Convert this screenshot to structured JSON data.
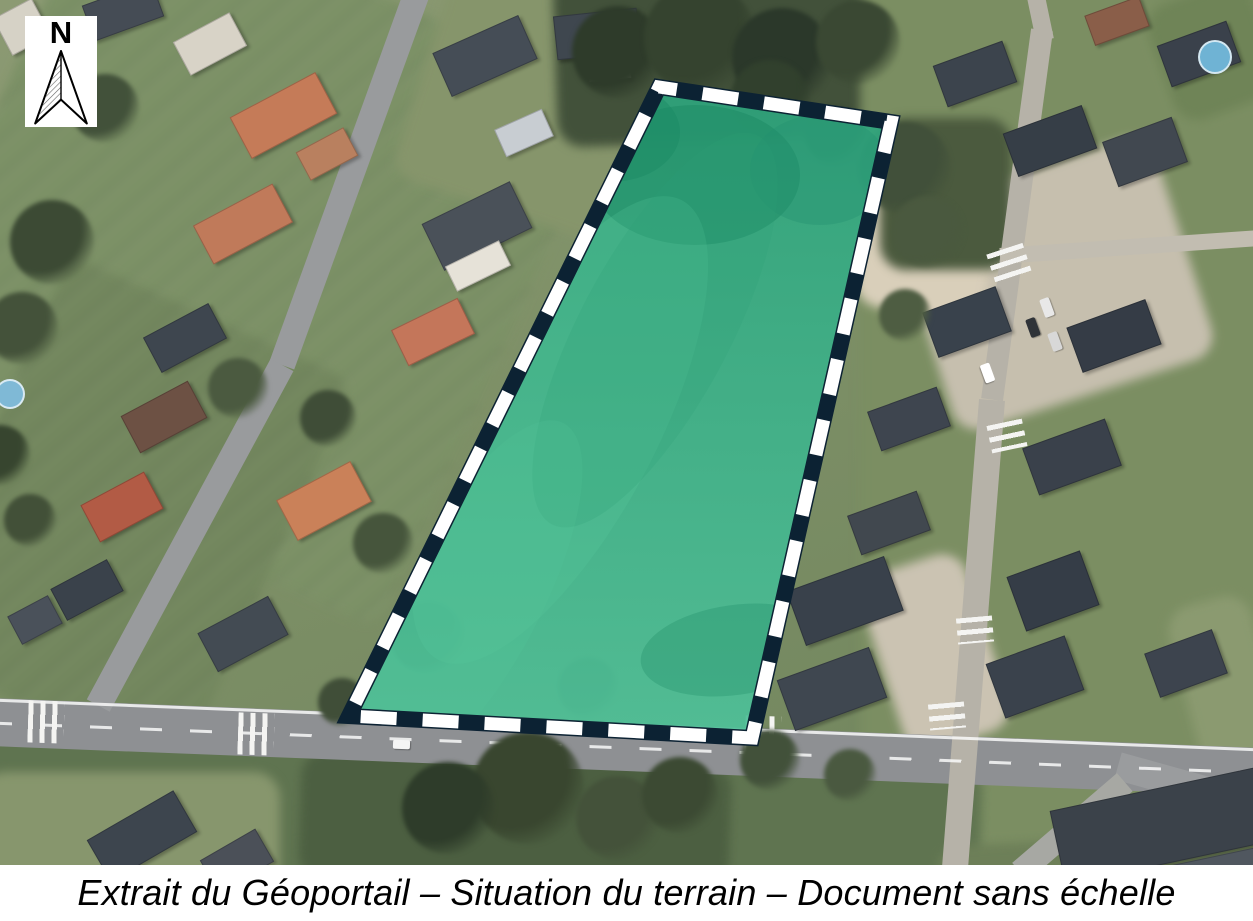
{
  "meta": {
    "width": 1253,
    "height": 921,
    "photo_height": 865
  },
  "caption": {
    "text": "Extrait du Géoportail – Situation du terrain – Document sans échelle"
  },
  "compass": {
    "label": "N"
  },
  "parcel": {
    "points": [
      [
        659,
        87
      ],
      [
        891,
        122
      ],
      [
        752,
        738
      ],
      [
        349,
        716
      ]
    ],
    "fill_top": "#2ea37b",
    "fill_bottom": "#4fc098",
    "fill_opacity": 0.93,
    "outline_color": "#0c2233",
    "outline_width": 16,
    "dash_color": "#ffffff",
    "dash_width": 13,
    "dash_length": 36,
    "dash_gap": 26,
    "shading": [
      [
        695,
        175,
        105,
        70,
        0,
        "#1b8a63",
        0.5
      ],
      [
        610,
        132,
        70,
        50,
        0,
        "#1b8a63",
        0.45
      ],
      [
        820,
        170,
        70,
        55,
        0,
        "#239070",
        0.35
      ],
      [
        735,
        650,
        95,
        45,
        -8,
        "#1f8d66",
        0.32
      ],
      [
        560,
        430,
        260,
        95,
        -62,
        "#5acb9f",
        0.22
      ],
      [
        655,
        330,
        220,
        75,
        -62,
        "#2f9e77",
        0.22
      ],
      [
        470,
        600,
        200,
        70,
        -62,
        "#55c69c",
        0.2
      ]
    ]
  },
  "scene": {
    "patches": [
      {
        "x": -40,
        "y": -40,
        "w": 560,
        "h": 580,
        "rot": 24,
        "c": "#7c9166",
        "stripes": true
      },
      {
        "x": -30,
        "y": 300,
        "w": 310,
        "h": 430,
        "rot": 24,
        "c": "#73875e",
        "stripes": true
      },
      {
        "x": 420,
        "y": -20,
        "w": 260,
        "h": 240,
        "rot": 18,
        "c": "#86956b",
        "stripes": false
      },
      {
        "x": 555,
        "y": -35,
        "w": 440,
        "h": 175,
        "rot": -2,
        "c": "#42513a",
        "stripes": false
      },
      {
        "x": 860,
        "y": -20,
        "w": 420,
        "h": 920,
        "rot": 0,
        "c": "#7b8e62",
        "stripes": false
      },
      {
        "x": 918,
        "y": 168,
        "w": 272,
        "h": 232,
        "rot": -18,
        "c": "#c6bfae",
        "stripes": false
      },
      {
        "x": 862,
        "y": 185,
        "w": 130,
        "h": 130,
        "rot": 10,
        "c": "#d9cfba",
        "stripes": false
      },
      {
        "x": 880,
        "y": 560,
        "w": 110,
        "h": 185,
        "rot": -18,
        "c": "#cbc3b2",
        "stripes": false
      },
      {
        "x": -20,
        "y": 748,
        "w": 1000,
        "h": 190,
        "rot": 2,
        "c": "#5f7450",
        "stripes": false
      },
      {
        "x": -20,
        "y": 772,
        "w": 300,
        "h": 160,
        "rot": 0,
        "c": "#87966d",
        "stripes": false
      },
      {
        "x": 300,
        "y": 757,
        "w": 430,
        "h": 130,
        "rot": 2,
        "c": "#4c5f41",
        "stripes": false
      },
      {
        "x": 880,
        "y": 118,
        "w": 132,
        "h": 152,
        "rot": 0,
        "c": "#4b5a3e",
        "stripes": false
      },
      {
        "x": 1158,
        "y": -10,
        "w": 110,
        "h": 122,
        "rot": -20,
        "c": "#6f8457",
        "stripes": false
      },
      {
        "x": 938,
        "y": 838,
        "w": 345,
        "h": 95,
        "rot": -3,
        "c": "#6d7f58",
        "stripes": false
      },
      {
        "x": 1188,
        "y": 598,
        "w": 85,
        "h": 205,
        "rot": -15,
        "c": "#8b9a70",
        "stripes": false
      }
    ],
    "roads": [
      [
        -10,
        722,
        1263,
        772,
        48,
        "#8e9093"
      ],
      [
        418,
        -10,
        282,
        365,
        26,
        "#999b9d"
      ],
      [
        282,
        365,
        98,
        706,
        26,
        "#999b9d"
      ],
      [
        1042,
        30,
        992,
        400,
        22,
        "#b6b2a8"
      ],
      [
        992,
        400,
        955,
        868,
        26,
        "#b6b2a8"
      ],
      [
        1000,
        256,
        1260,
        238,
        16,
        "#c2bdb1"
      ],
      [
        1118,
        766,
        1262,
        806,
        28,
        "#9a9c9e"
      ],
      [
        1020,
        872,
        1125,
        782,
        24,
        "#a7a8a3"
      ],
      [
        1035,
        -8,
        1045,
        40,
        18,
        "#b6b2a8"
      ]
    ],
    "road_lines": [
      [
        -10,
        700,
        1263,
        750,
        3,
        "solid"
      ],
      [
        -10,
        723,
        1263,
        773,
        3,
        "dashed"
      ]
    ],
    "crosswalks": [
      [
        28,
        701,
        2,
        36,
        42
      ],
      [
        238,
        713,
        2,
        36,
        42
      ],
      [
        745,
        716,
        2,
        36,
        42
      ],
      [
        994,
        244,
        72,
        30,
        38
      ],
      [
        993,
        418,
        78,
        28,
        36
      ],
      [
        962,
        612,
        85,
        26,
        36
      ],
      [
        934,
        698,
        85,
        26,
        36
      ]
    ],
    "houses": [
      [
        0,
        6,
        42,
        40,
        -28,
        "#d6d2c6"
      ],
      [
        86,
        -8,
        72,
        36,
        -20,
        "#454c55"
      ],
      [
        235,
        92,
        95,
        45,
        -28,
        "#c57b58"
      ],
      [
        300,
        138,
        52,
        30,
        -28,
        "#b9805f"
      ],
      [
        178,
        25,
        62,
        36,
        -28,
        "#d8d3c7"
      ],
      [
        438,
        32,
        92,
        46,
        -24,
        "#454d56"
      ],
      [
        498,
        118,
        50,
        28,
        -24,
        "#c8cdd2"
      ],
      [
        555,
        12,
        82,
        42,
        -6,
        "#3f474f"
      ],
      [
        588,
        54,
        40,
        24,
        -6,
        "#e4dfd4"
      ],
      [
        198,
        202,
        88,
        42,
        -28,
        "#c07a5a"
      ],
      [
        428,
        200,
        96,
        50,
        -26,
        "#4a5159"
      ],
      [
        448,
        252,
        58,
        26,
        -26,
        "#e6e2d8"
      ],
      [
        396,
        312,
        72,
        38,
        -26,
        "#c4765a"
      ],
      [
        148,
        318,
        72,
        38,
        -28,
        "#3e464f"
      ],
      [
        126,
        396,
        74,
        40,
        -28,
        "#6d5144"
      ],
      [
        86,
        486,
        70,
        40,
        -28,
        "#b25b45"
      ],
      [
        282,
        478,
        82,
        44,
        -28,
        "#ca8159"
      ],
      [
        203,
        612,
        78,
        42,
        -28,
        "#434b53"
      ],
      [
        55,
        572,
        62,
        34,
        -28,
        "#3a424b"
      ],
      [
        12,
        604,
        44,
        30,
        -28,
        "#4a515a"
      ],
      [
        92,
        812,
        98,
        46,
        -30,
        "#3d454e"
      ],
      [
        205,
        842,
        62,
        36,
        -30,
        "#4b5058"
      ],
      [
        938,
        52,
        72,
        42,
        -20,
        "#3c444d"
      ],
      [
        1008,
        118,
        82,
        44,
        -20,
        "#363e47"
      ],
      [
        1108,
        128,
        72,
        46,
        -20,
        "#414850"
      ],
      [
        1162,
        32,
        72,
        42,
        -20,
        "#3a414b"
      ],
      [
        1088,
        5,
        56,
        30,
        -20,
        "#8a5e49"
      ],
      [
        928,
        298,
        76,
        46,
        -20,
        "#39424c"
      ],
      [
        1072,
        312,
        82,
        46,
        -20,
        "#353c46"
      ],
      [
        872,
        398,
        72,
        40,
        -20,
        "#3e454f"
      ],
      [
        1028,
        432,
        86,
        48,
        -20,
        "#3a414b"
      ],
      [
        852,
        502,
        72,
        40,
        -20,
        "#41484f"
      ],
      [
        793,
        572,
        102,
        56,
        -20,
        "#39414b"
      ],
      [
        783,
        662,
        96,
        52,
        -20,
        "#3f4750"
      ],
      [
        1014,
        562,
        76,
        56,
        -20,
        "#353d47"
      ],
      [
        993,
        648,
        82,
        56,
        -20,
        "#3a424c"
      ],
      [
        1150,
        640,
        70,
        45,
        -20,
        "#3d444e"
      ],
      [
        1055,
        786,
        230,
        74,
        -12,
        "#3b424a"
      ],
      [
        1145,
        852,
        180,
        48,
        -12,
        "#50575f"
      ]
    ],
    "trees": [
      [
        618,
        52,
        46,
        "#2e3b2a"
      ],
      [
        700,
        38,
        56,
        "#35432f"
      ],
      [
        782,
        58,
        50,
        "#2b382a"
      ],
      [
        858,
        42,
        42,
        "#3a4833"
      ],
      [
        905,
        168,
        46,
        "#41503a"
      ],
      [
        928,
        232,
        36,
        "#4a593f"
      ],
      [
        52,
        242,
        42,
        "#3c4a34"
      ],
      [
        22,
        328,
        36,
        "#44523a"
      ],
      [
        238,
        388,
        30,
        "#4b5a40"
      ],
      [
        328,
        418,
        28,
        "#3f4d37"
      ],
      [
        383,
        543,
        30,
        "#46553c"
      ],
      [
        428,
        638,
        36,
        "#3b4933"
      ],
      [
        528,
        788,
        56,
        "#39462f"
      ],
      [
        448,
        808,
        46,
        "#2e3c2a"
      ],
      [
        618,
        818,
        42,
        "#44523a"
      ],
      [
        680,
        795,
        38,
        "#3c4a33"
      ],
      [
        342,
        702,
        24,
        "#404e38"
      ],
      [
        588,
        688,
        30,
        "#47553d"
      ],
      [
        105,
        108,
        34,
        "#42513a"
      ],
      [
        60,
        60,
        30,
        "#394733"
      ],
      [
        0,
        455,
        30,
        "#37452f"
      ],
      [
        30,
        520,
        26,
        "#425038"
      ],
      [
        770,
        100,
        40,
        "#31402d"
      ],
      [
        835,
        135,
        30,
        "#3b4934"
      ],
      [
        905,
        315,
        26,
        "#4e5d42"
      ],
      [
        770,
        760,
        30,
        "#42513a"
      ],
      [
        850,
        775,
        26,
        "#4a5940"
      ]
    ],
    "cars": [
      [
        1042,
        298,
        10,
        19,
        -20,
        "#e8e8e8"
      ],
      [
        1028,
        318,
        10,
        19,
        -20,
        "#2f3338"
      ],
      [
        1050,
        332,
        10,
        19,
        -20,
        "#d8d8d8"
      ],
      [
        978,
        368,
        19,
        10,
        70,
        "#ffffff"
      ],
      [
        393,
        740,
        17,
        9,
        2,
        "#f5f5f5"
      ],
      [
        660,
        60,
        16,
        9,
        -6,
        "#e2e2e2"
      ]
    ],
    "pools": [
      [
        8,
        392,
        13,
        "#7fb9d6"
      ],
      [
        1213,
        55,
        15,
        "#6fb3d4"
      ]
    ]
  }
}
